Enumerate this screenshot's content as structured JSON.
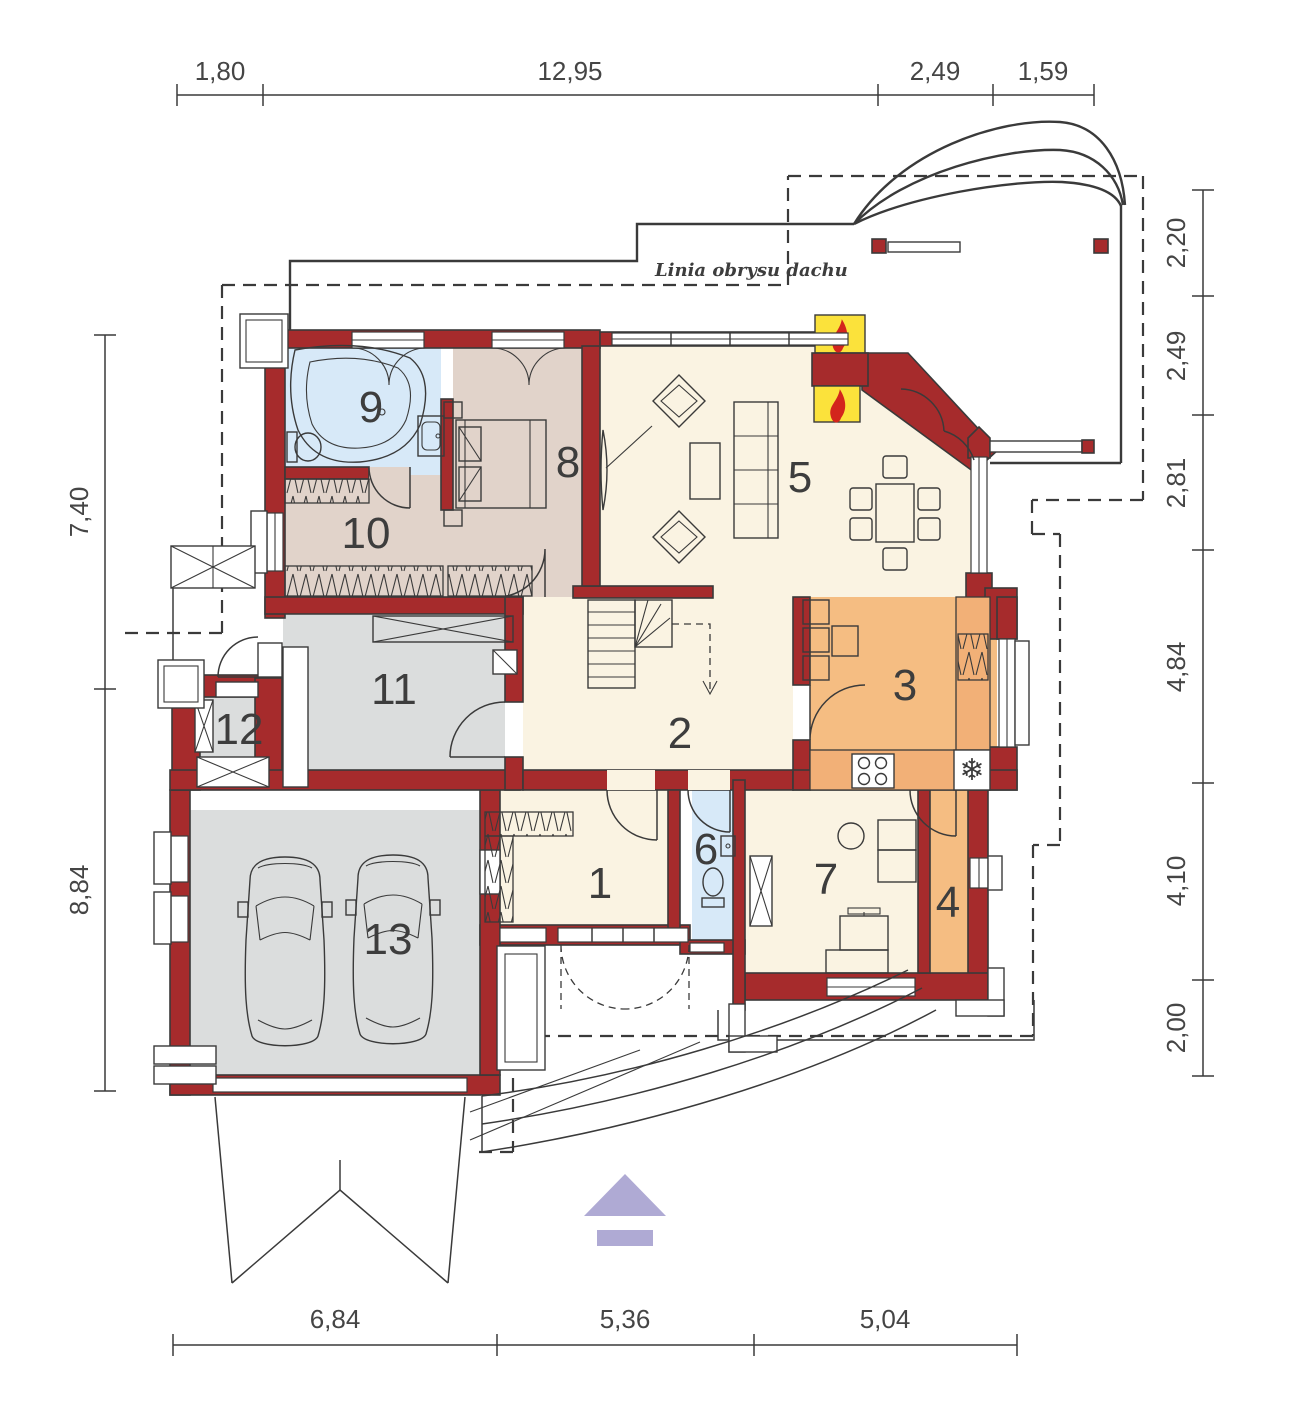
{
  "drawing": {
    "roof_label": "Linia obrysu dachu"
  },
  "rooms": [
    {
      "label": "1"
    },
    {
      "label": "2"
    },
    {
      "label": "3"
    },
    {
      "label": "4"
    },
    {
      "label": "5"
    },
    {
      "label": "6"
    },
    {
      "label": "7"
    },
    {
      "label": "8"
    },
    {
      "label": "9"
    },
    {
      "label": "10"
    },
    {
      "label": "11"
    },
    {
      "label": "12"
    },
    {
      "label": "13"
    }
  ],
  "dimensions": {
    "top": [
      "1,80",
      "12,95",
      "2,49",
      "1,59"
    ],
    "right": [
      "2,20",
      "2,49",
      "2,81",
      "4,84",
      "4,10",
      "2,00"
    ],
    "left": [
      "7,40",
      "8,84"
    ],
    "bottom": [
      "6,84",
      "5,36",
      "5,04"
    ]
  },
  "icons": {
    "freezer": "❄"
  },
  "colors": {
    "wall": "#A62B2C",
    "line": "#3A3A3A",
    "floor_main": "#FAF3E2",
    "floor_bath": "#D7E9F8",
    "floor_bedroom": "#E1D3CA",
    "floor_kitchen": "#F5BD82",
    "floor_garage": "#DBDDDD",
    "chimney": "#FBE23B",
    "flame": "#D3251C",
    "arrow": "#AFAAD4"
  }
}
